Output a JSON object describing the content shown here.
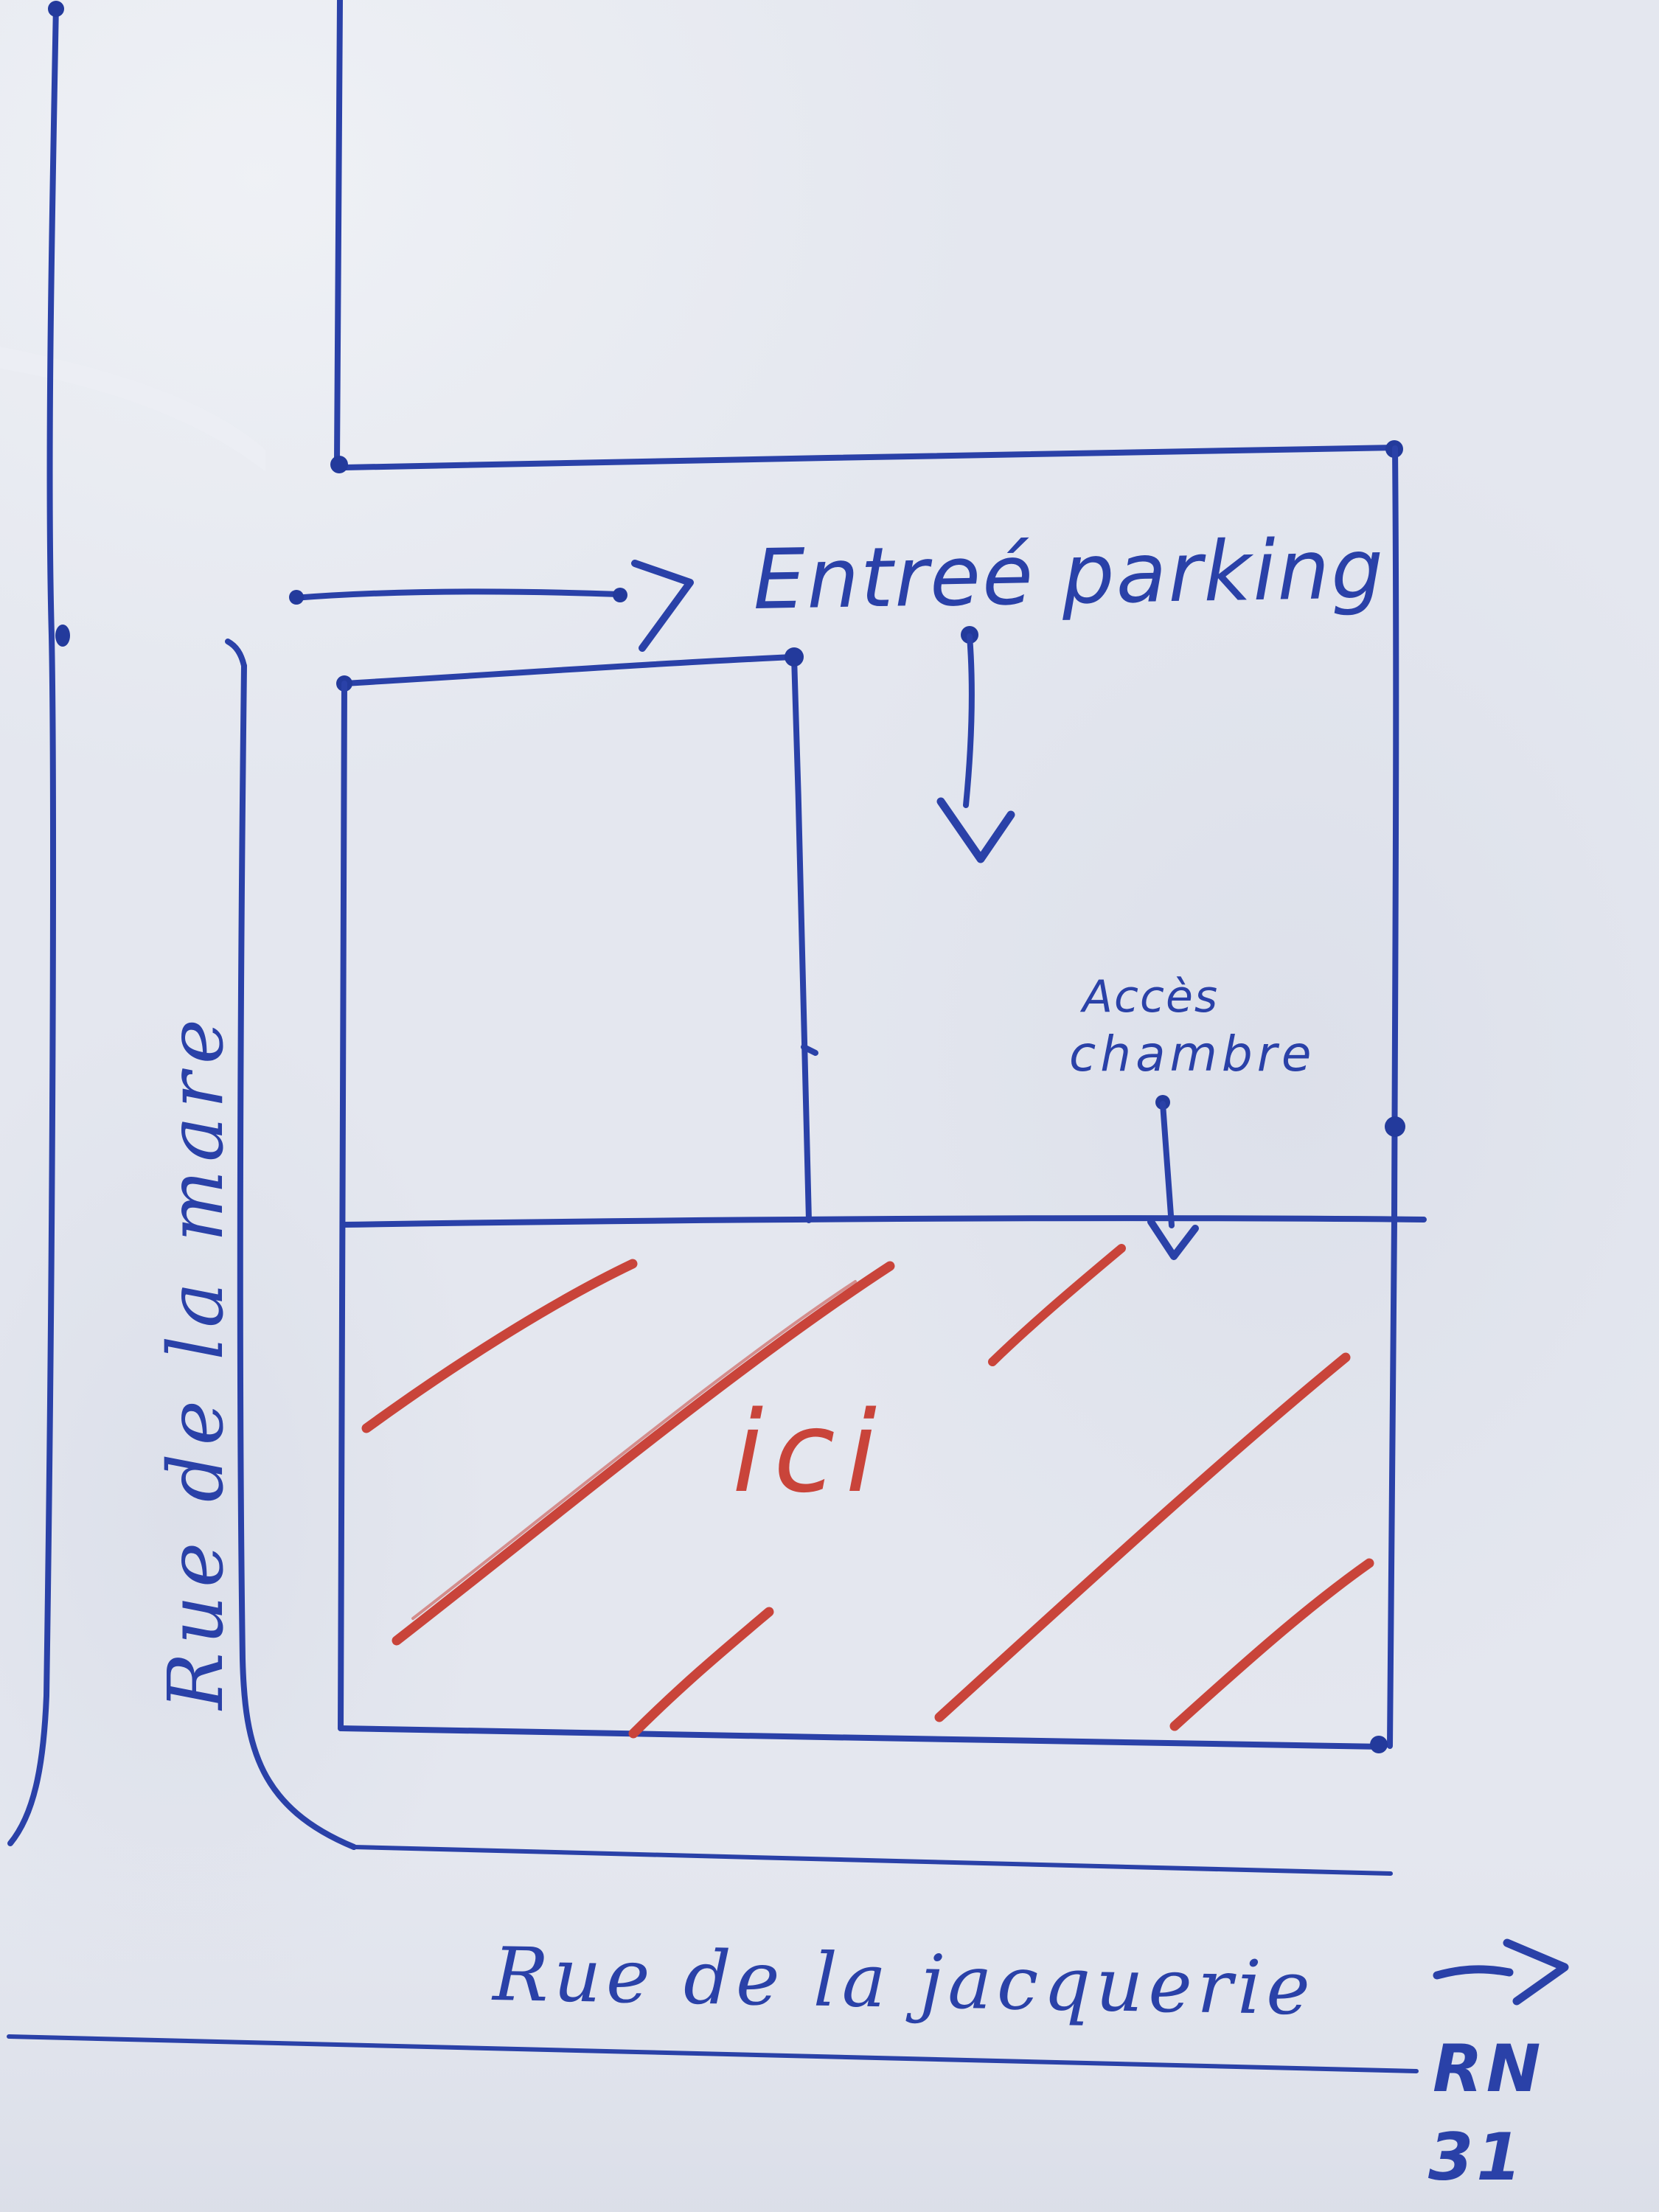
{
  "map": {
    "kind": "hand-drawn-directions-sketch",
    "colors": {
      "ink": "#2a41a8",
      "marker_red": "#c9443a",
      "paper": "#e4e7ef"
    },
    "icons": {
      "parking_entrance_arrow": "arrow-right",
      "parking_down_arrow": "arrow-down",
      "room_access_arrow": "arrow-down",
      "highway_arrow": "arrow-right"
    },
    "labels": {
      "parking_entrance": "Entreé parking",
      "room_access_line1": "Accès",
      "room_access_line2": "chambre",
      "street_left": "Rue de la mare",
      "street_bottom": "Rue de la jacquerie",
      "here_marker": "ici",
      "highway_line1": "RN",
      "highway_line2": "31"
    }
  }
}
